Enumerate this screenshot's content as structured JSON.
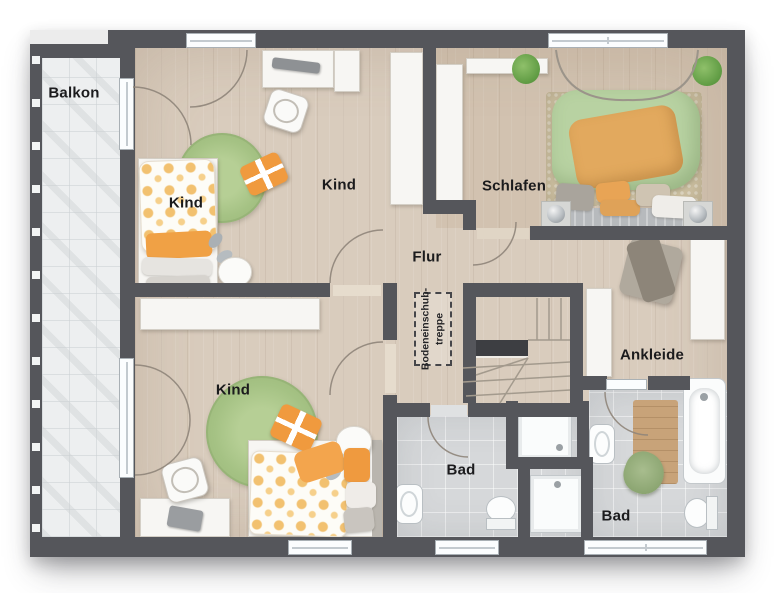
{
  "plan": {
    "rooms": {
      "balkon": {
        "label": "Balkon"
      },
      "kind_top_left": {
        "label": "Kind"
      },
      "kind_top_mid": {
        "label": "Kind"
      },
      "schlafen": {
        "label": "Schlafen"
      },
      "flur": {
        "label": "Flur"
      },
      "kind_bottom": {
        "label": "Kind"
      },
      "ankleide": {
        "label": "Ankleide"
      },
      "bad_center": {
        "label": "Bad"
      },
      "bad_right": {
        "label": "Bad"
      },
      "attic_stairs": {
        "line1": "Bodeneinschub-",
        "line2": "treppe"
      }
    },
    "colors": {
      "wall": "#55565b",
      "wood_floor": "#d9ccbd",
      "balcony_tile": "#edeff0",
      "bath_tile": "#d6d8da",
      "rug_green": "#a5c284",
      "accent_orange": "#f09a3e",
      "duvet_green": "#b8d2a2",
      "blanket_orange": "#e2a95e",
      "furniture_white": "#f7f6f3",
      "stair_void": "#3d3e42"
    }
  }
}
